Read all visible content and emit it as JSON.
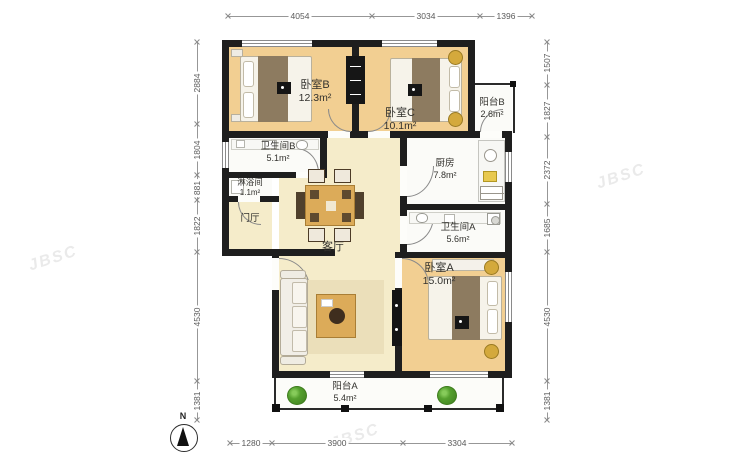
{
  "watermark": {
    "text": "JBSC"
  },
  "compass": {
    "label": "N"
  },
  "rooms": {
    "bedroomB": {
      "label": "卧室B",
      "area": "12.3m²"
    },
    "bedroomC": {
      "label": "卧室C",
      "area": "10.1m²"
    },
    "balconyB": {
      "label": "阳台B",
      "area": "2.6m²"
    },
    "bathroomB": {
      "label": "卫生间B",
      "area": "5.1m²"
    },
    "shower": {
      "label": "淋浴间",
      "area": "1.1m²"
    },
    "hall": {
      "label": "门厅",
      "area": ""
    },
    "kitchen": {
      "label": "厨房",
      "area": "7.8m²"
    },
    "living": {
      "label": "客厅",
      "area": ""
    },
    "bathroomA": {
      "label": "卫生间A",
      "area": "5.6m²"
    },
    "bedroomA": {
      "label": "卧室A",
      "area": "15.0m²"
    },
    "balconyA": {
      "label": "阳台A",
      "area": "5.4m²"
    }
  },
  "dimensions": {
    "top": [
      "4054",
      "3034",
      "1396"
    ],
    "bottom": [
      "1280",
      "3900",
      "3304"
    ],
    "left": [
      "2884",
      "1804",
      "881",
      "1822",
      "4530",
      "1381"
    ],
    "right": [
      "1507",
      "1827",
      "2372",
      "1685",
      "4530",
      "1381"
    ]
  },
  "colors": {
    "wall": "#1e1e1e",
    "bedroom_floor": "#f2cf92",
    "living_floor": "#f5ecca",
    "wet_floor": "#fbfbf8",
    "wood": "#dcab59",
    "plant": "#55a02e",
    "dim_text": "#5a5a5a"
  }
}
